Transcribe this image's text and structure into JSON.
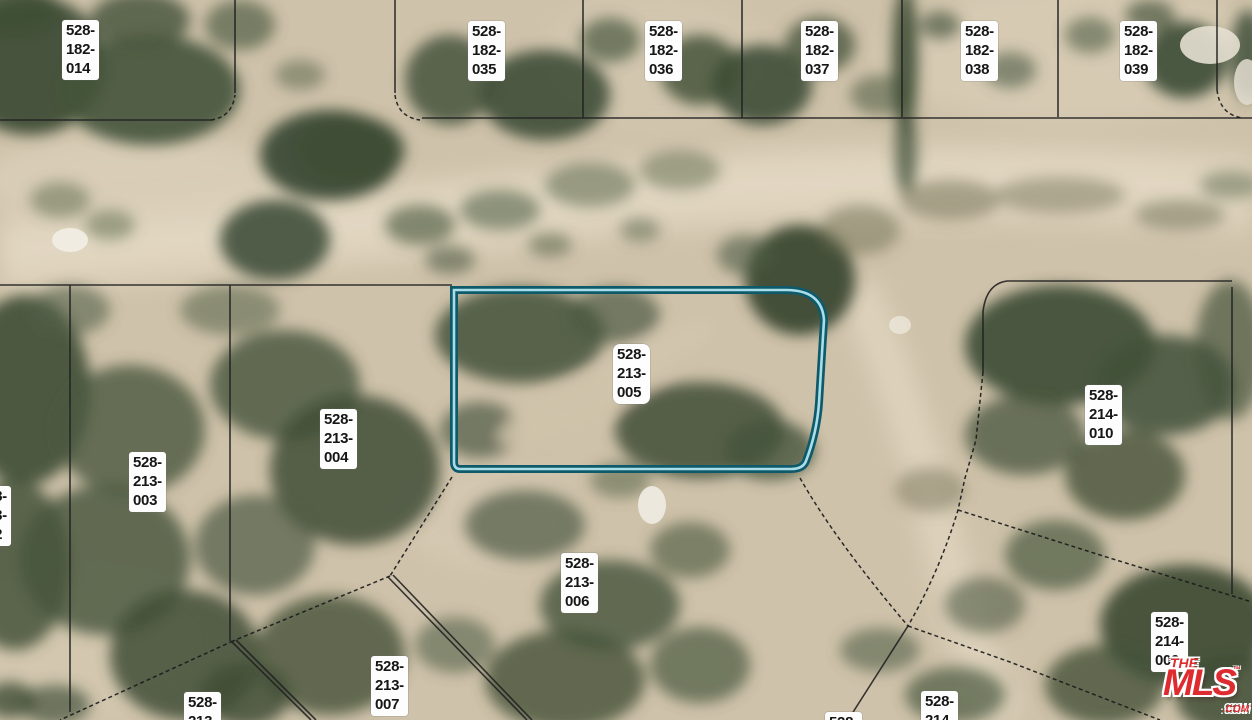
{
  "map": {
    "type": "aerial-parcel-map",
    "highlighted_parcel": {
      "apn": "528-213-005",
      "outline_color": "#0e5a6b"
    },
    "labels": [
      {
        "apn": "528-182-014",
        "lines": [
          "528-",
          "182-",
          "014"
        ],
        "x": 62,
        "y": 20
      },
      {
        "apn": "528-182-035",
        "lines": [
          "528-",
          "182-",
          "035"
        ],
        "x": 468,
        "y": 21
      },
      {
        "apn": "528-182-036",
        "lines": [
          "528-",
          "182-",
          "036"
        ],
        "x": 645,
        "y": 21
      },
      {
        "apn": "528-182-037",
        "lines": [
          "528-",
          "182-",
          "037"
        ],
        "x": 801,
        "y": 21
      },
      {
        "apn": "528-182-038",
        "lines": [
          "528-",
          "182-",
          "038"
        ],
        "x": 961,
        "y": 21
      },
      {
        "apn": "528-182-039",
        "lines": [
          "528-",
          "182-",
          "039"
        ],
        "x": 1120,
        "y": 21
      },
      {
        "apn": "528-213-005",
        "lines": [
          "528-",
          "213-",
          "005"
        ],
        "x": 613,
        "y": 344,
        "highlighted": true
      },
      {
        "apn": "528-213-004",
        "lines": [
          "528-",
          "213-",
          "004"
        ],
        "x": 320,
        "y": 409
      },
      {
        "apn": "528-213-003",
        "lines": [
          "528-",
          "213-",
          "003"
        ],
        "x": 129,
        "y": 452
      },
      {
        "apn": "528-213-002",
        "lines": [
          "528-",
          "213-",
          "002"
        ],
        "x": -26,
        "y": 486,
        "clipped": "left"
      },
      {
        "apn": "528-213-006",
        "lines": [
          "528-",
          "213-",
          "006"
        ],
        "x": 561,
        "y": 553
      },
      {
        "apn": "528-213-007",
        "lines": [
          "528-",
          "213-",
          "007"
        ],
        "x": 371,
        "y": 656
      },
      {
        "apn_partial": "528-213",
        "lines": [
          "528-",
          "213-"
        ],
        "x": 184,
        "y": 692,
        "clipped": "bottom"
      },
      {
        "apn": "528-214-010",
        "lines": [
          "528-",
          "214-",
          "010"
        ],
        "x": 1085,
        "y": 385
      },
      {
        "apn": "528-214-009",
        "lines": [
          "528-",
          "214-",
          "009"
        ],
        "x": 1151,
        "y": 612
      },
      {
        "apn_partial": "528-214",
        "lines": [
          "528-",
          "214-"
        ],
        "x": 921,
        "y": 691,
        "clipped": "bottom"
      },
      {
        "apn_partial": "528",
        "lines": [
          "528-"
        ],
        "x": 825,
        "y": 712,
        "clipped": "bottom"
      }
    ]
  },
  "watermark": {
    "brand_top": "THE",
    "brand_main": "MLS",
    "trademark": "™",
    "brand_suffix": ".COM",
    "color": "#dd2b30"
  }
}
